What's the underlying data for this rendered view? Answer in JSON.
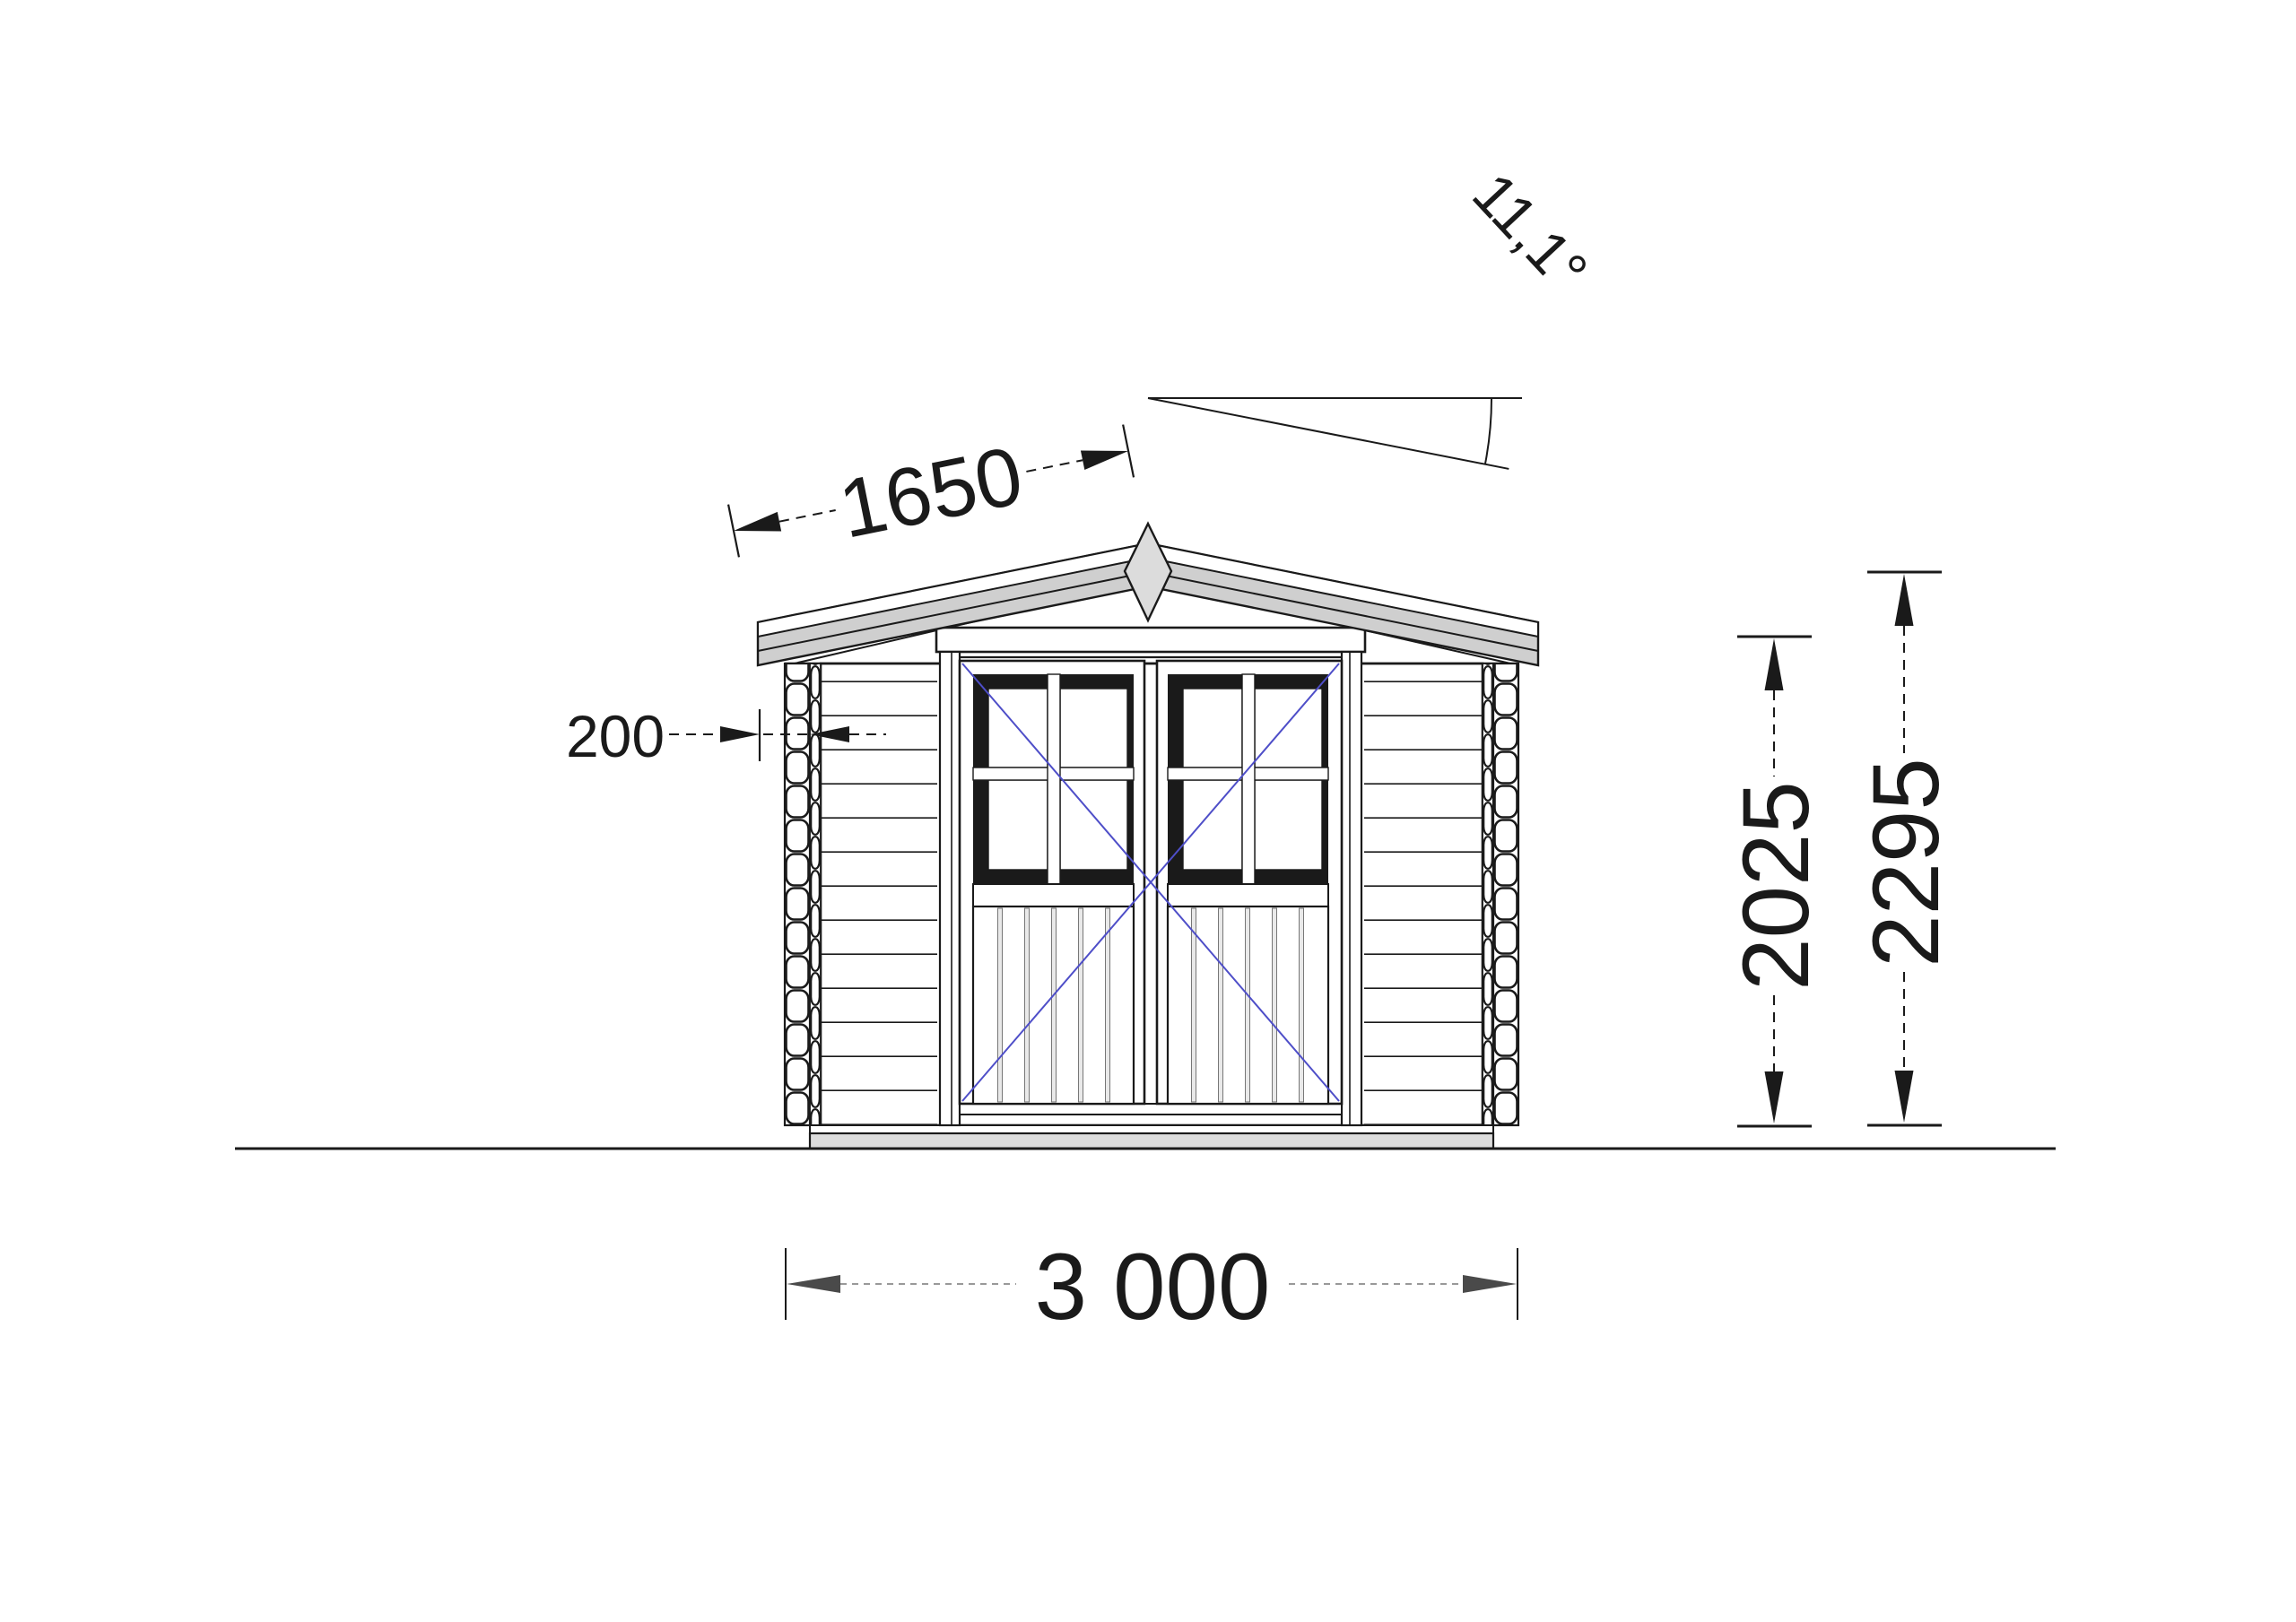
{
  "drawing": {
    "type": "technical-elevation-front-view",
    "subject": "log-cabin-shed-with-double-glazed-door",
    "labels": {
      "slope_length": "1650",
      "roof_angle": "11,1°",
      "wall_offset": "200",
      "wall_height": "2025",
      "total_height": "2295",
      "overall_width": "3 000"
    },
    "colors": {
      "line": "#1a1a1a",
      "roof_fill": "#cfcfcf",
      "roof_strip": "#ffffff",
      "finial_fill": "#dcdcdc",
      "slab_fill": "#dcdcdc",
      "plank_fill": "#e9e9e9",
      "door_swing": "#4e4ec8",
      "dim_arrow_gray": "#4a4a4a"
    }
  }
}
